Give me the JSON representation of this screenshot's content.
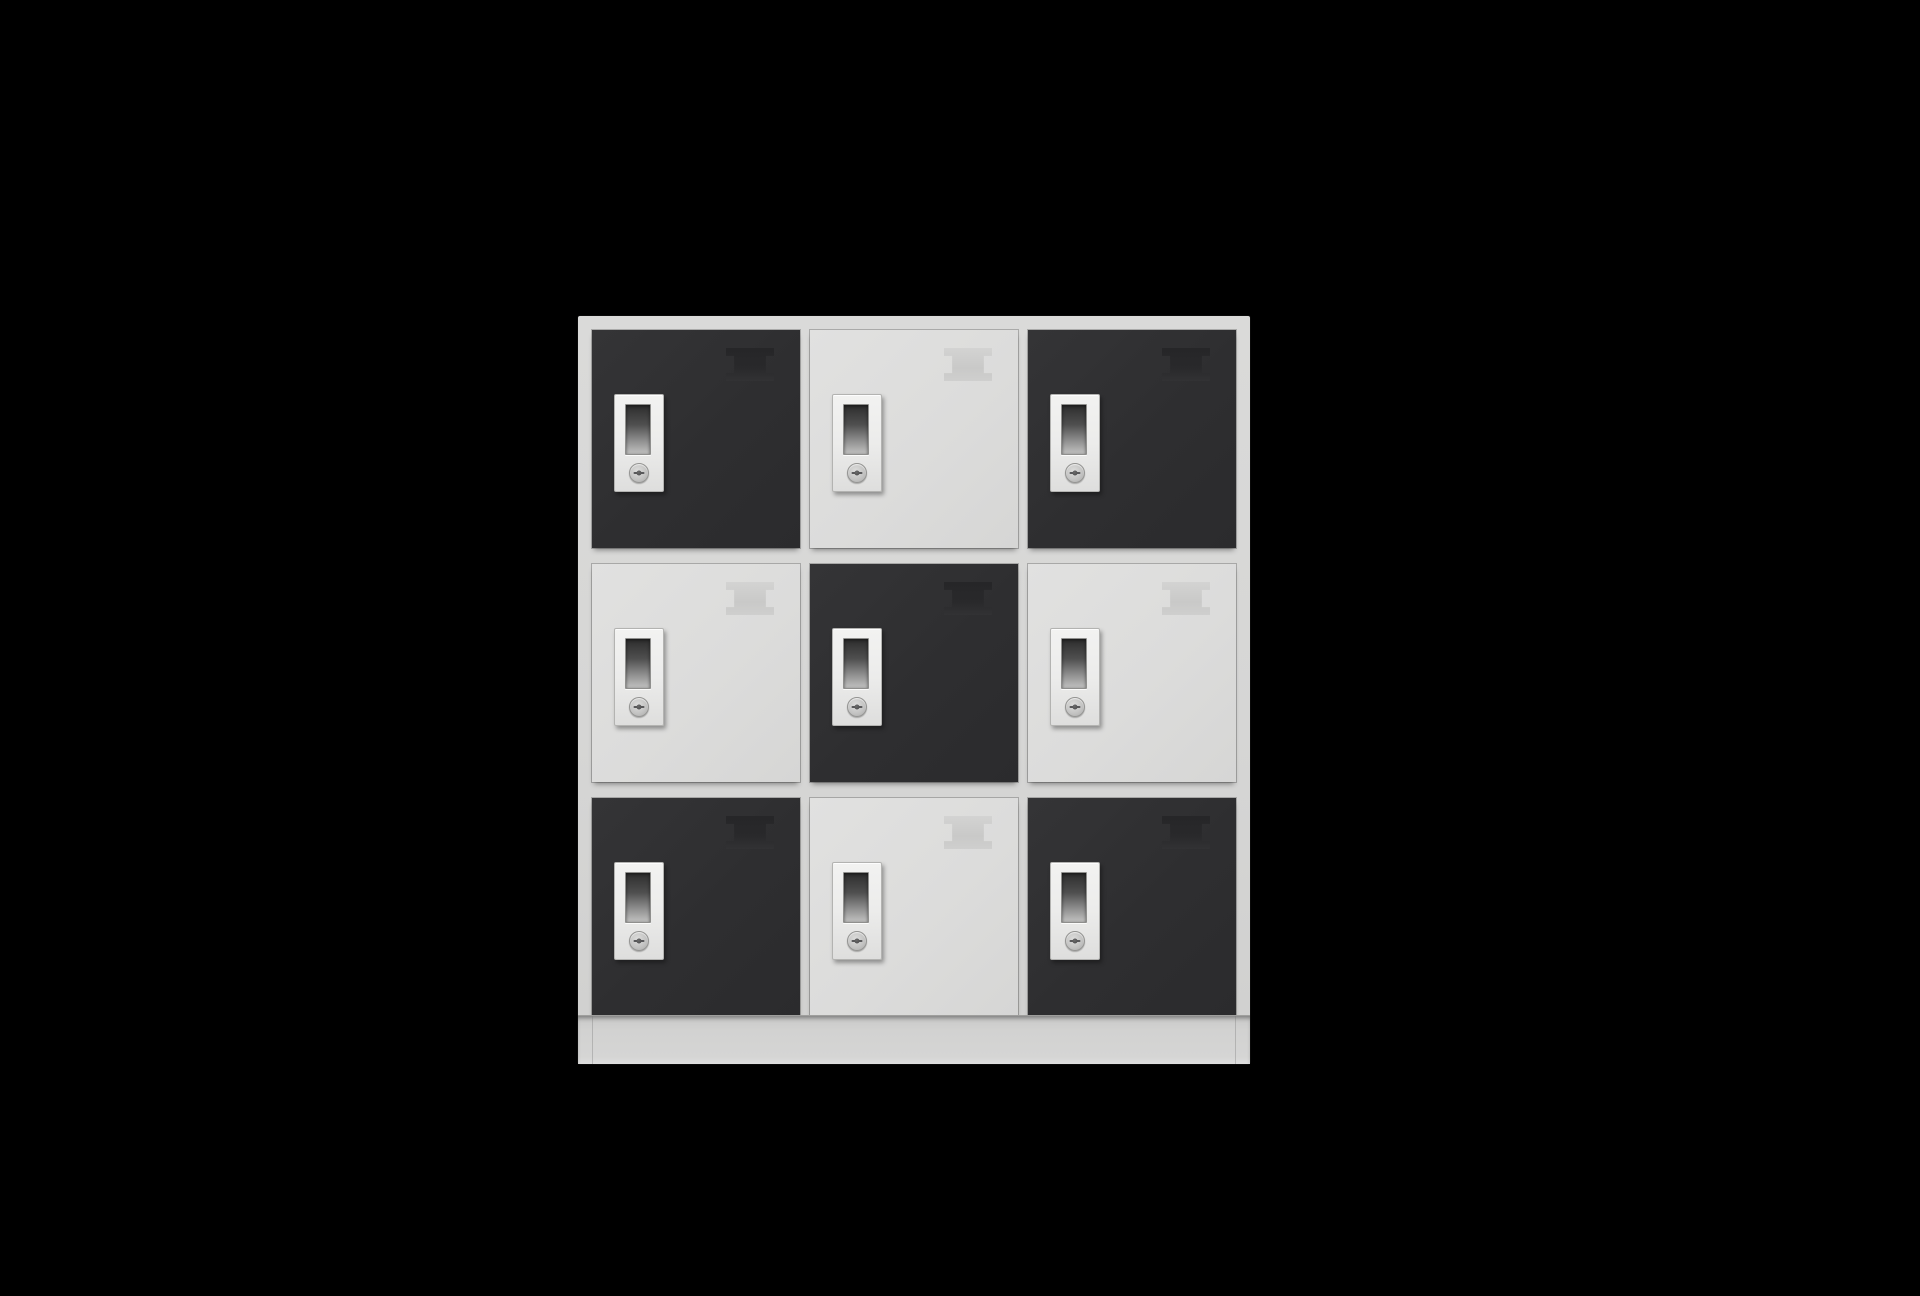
{
  "scene": {
    "description": "Product photo of a 3x3 cube storage locker cabinet with alternating charcoal and white doors on a black background",
    "visible_text": []
  },
  "cabinet": {
    "rows": 3,
    "columns": 3,
    "compartment_count": 9,
    "pattern": "checkerboard",
    "colors": {
      "background": "#000000",
      "frame": "#d6d6d5",
      "base": "#d2d2d1",
      "door_dark": "#2e2e30",
      "door_light": "#dcdcdb",
      "handle_plate": "#ececeb",
      "lock": "#c4c4c3",
      "vent_dark": "#29292b",
      "vent_light": "#c9c9c8"
    },
    "doors": [
      {
        "row": 1,
        "col": 1,
        "tone": "dark"
      },
      {
        "row": 1,
        "col": 2,
        "tone": "light"
      },
      {
        "row": 1,
        "col": 3,
        "tone": "dark"
      },
      {
        "row": 2,
        "col": 1,
        "tone": "light"
      },
      {
        "row": 2,
        "col": 2,
        "tone": "dark"
      },
      {
        "row": 2,
        "col": 3,
        "tone": "light"
      },
      {
        "row": 3,
        "col": 1,
        "tone": "dark"
      },
      {
        "row": 3,
        "col": 2,
        "tone": "light"
      },
      {
        "row": 3,
        "col": 3,
        "tone": "dark"
      }
    ],
    "door_features": [
      {
        "name": "label-slot-vent",
        "shape": "i-beam-cutout",
        "position": "top-right"
      },
      {
        "name": "handle-plate-with-grip-recess",
        "position": "left-middle"
      },
      {
        "name": "cam-lock-keyhole",
        "position": "below-grip"
      }
    ]
  }
}
